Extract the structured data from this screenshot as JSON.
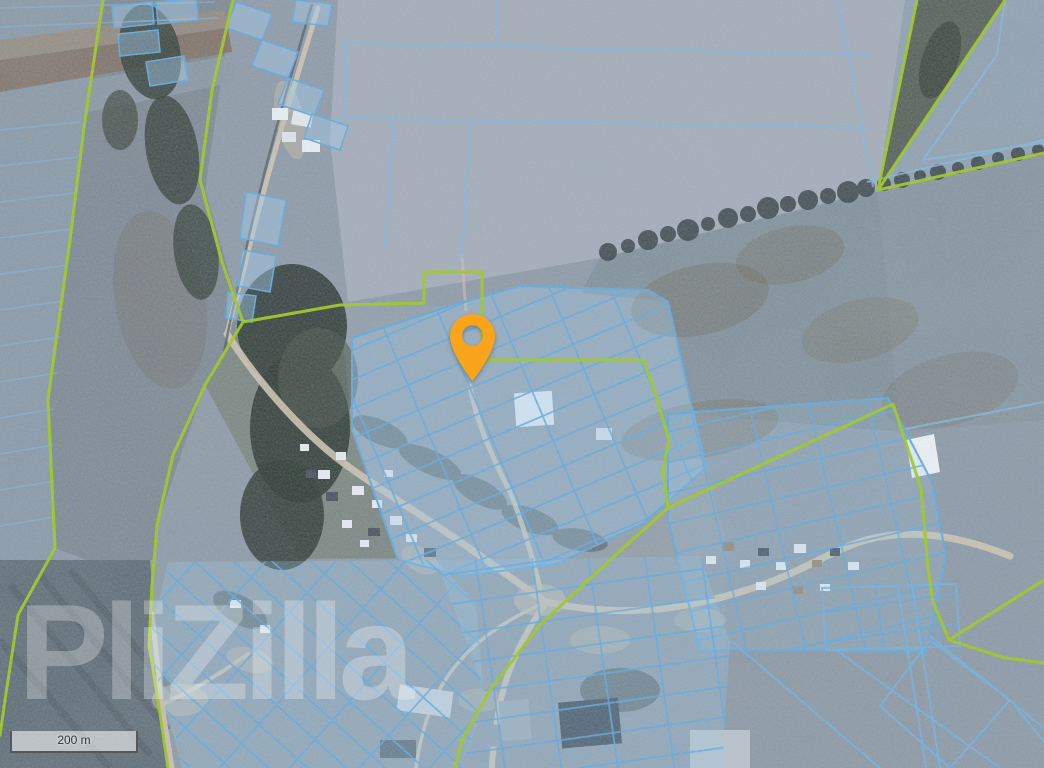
{
  "map": {
    "kind": "satellite-imagery-with-cadastral-overlay",
    "watermark_text": "PliZilla",
    "scale_bar": {
      "distance_label": "200 m"
    },
    "marker": {
      "type": "location-pin",
      "color": "#F9A41B",
      "position_px": {
        "x": 472,
        "y": 381
      }
    },
    "legend_colors": {
      "cadastral_parcel_line": "#5EA7DD",
      "cadastral_parcel_fill": "rgba(151,203,241,0.32)",
      "settlement_boundary_line": "#9CC817",
      "road_fill": "#CFC5B2",
      "imagery_base_tint": "#8C99A7"
    },
    "layers": [
      "satellite-imagery",
      "cadastral-parcels",
      "settlement-boundaries",
      "location-marker",
      "scale-bar",
      "watermark"
    ]
  }
}
